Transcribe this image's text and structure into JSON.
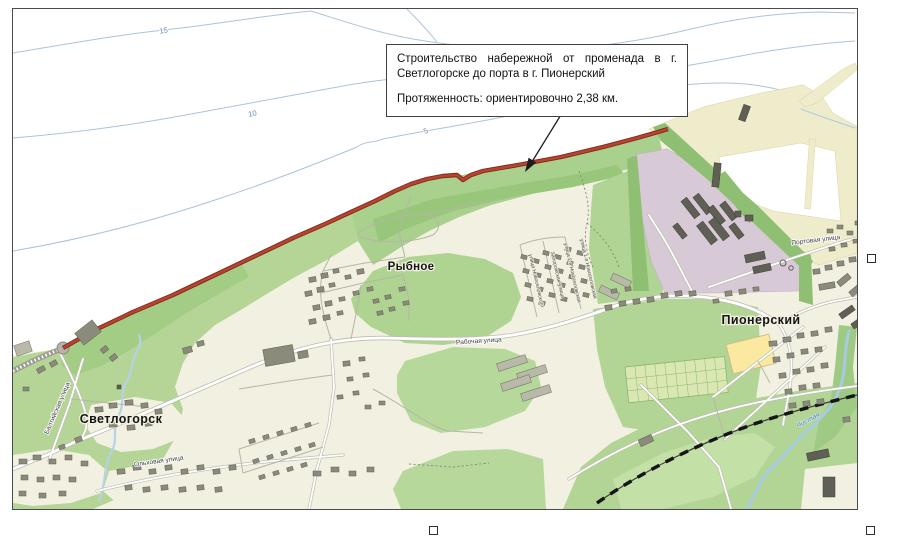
{
  "annotation_box": {
    "paragraph1": "Строительство набережной от променада в г. Светлогорске до порта в г. Пионерский",
    "paragraph2": "Протяженность: ориентировочно 2,38 км."
  },
  "map": {
    "depths": {
      "d15": "15",
      "d10": "10",
      "d5": "5"
    },
    "settlements": {
      "svetlogorsk": "Светлогорск",
      "rybnoe": "Рыбное",
      "pionersky": "Пионерский"
    },
    "streets": {
      "portovaya": "Портовая улица",
      "rabochaya": "Рабочая улица",
      "baltiyskaya": "Балтийская улица",
      "olkhovaya": "Ольховая улица",
      "novoselovskogo": "улица Новоселовского",
      "zaporozhskaya": "Запорожская улица",
      "novoselovskaya_1": "улица 1-я Новоселовская",
      "novoselovskaya_2": "улица 2-я Новоселовская"
    },
    "rivers": {
      "chistaya": "Чистая"
    }
  },
  "colors": {
    "route_red": "#b8432e",
    "land_cream": "#f2f0e1",
    "forest_green": "#b4d596",
    "port_mauve": "#d8c9d6",
    "beach_yellow": "#efeccb",
    "water_blue": "#a8cbe4",
    "contour_blue": "#a9c4da"
  }
}
